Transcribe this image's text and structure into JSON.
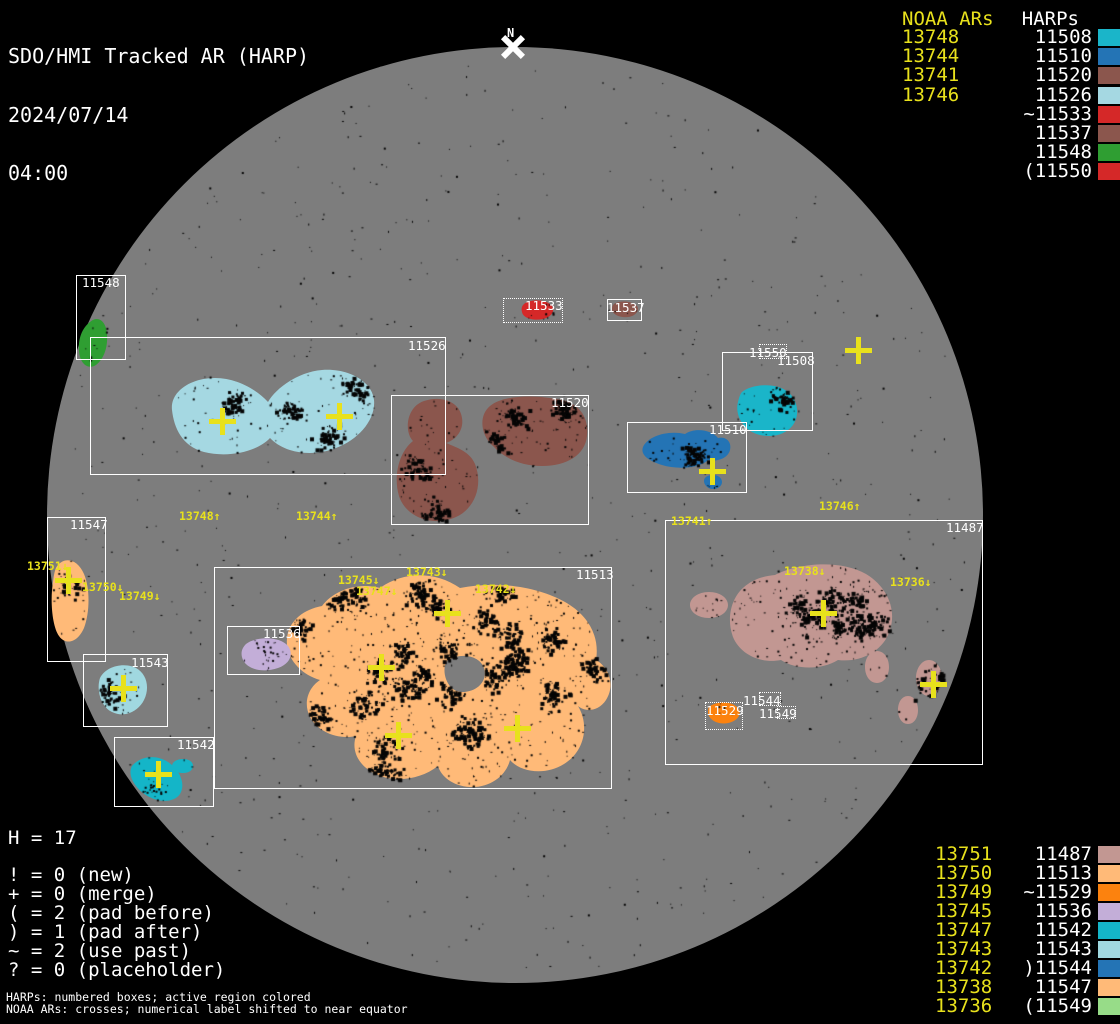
{
  "title": {
    "line1": "SDO/HMI Tracked AR (HARP)",
    "line2": "2024/07/14",
    "line3": "04:00"
  },
  "north": {
    "label": "N"
  },
  "sun": {
    "disk_color": "#7d7d7d",
    "speckle_color": "#050505"
  },
  "legend_top": {
    "noaa_header": "NOAA ARs",
    "harp_header": "HARPs",
    "rows": [
      {
        "noaa": "13748",
        "harp": "11508",
        "color": "#1ab5c9"
      },
      {
        "noaa": "13744",
        "harp": "11510",
        "color": "#2474b5"
      },
      {
        "noaa": "13741",
        "harp": "11520",
        "color": "#8b564d"
      },
      {
        "noaa": "13746",
        "harp": "11526",
        "color": "#a5d8e2"
      },
      {
        "noaa": "",
        "harp": "~11533",
        "color": "#d52828"
      },
      {
        "noaa": "",
        "harp": "11537",
        "color": "#8b564d"
      },
      {
        "noaa": "",
        "harp": "11548",
        "color": "#2f9e32"
      },
      {
        "noaa": "",
        "harp": "(11550",
        "color": "#d52828"
      }
    ]
  },
  "legend_bottom": {
    "rows": [
      {
        "noaa": "13751",
        "harp": "11487",
        "color": "#c29792"
      },
      {
        "noaa": "13750",
        "harp": "11513",
        "color": "#ffba78"
      },
      {
        "noaa": "13749",
        "harp": "~11529",
        "color": "#fc820e"
      },
      {
        "noaa": "13745",
        "harp": "11536",
        "color": "#c3aed8"
      },
      {
        "noaa": "13747",
        "harp": "11542",
        "color": "#14b5c8"
      },
      {
        "noaa": "13743",
        "harp": "11543",
        "color": "#a0d8e0"
      },
      {
        "noaa": "13742",
        "harp": ")11544",
        "color": "#2474b5"
      },
      {
        "noaa": "13738",
        "harp": "11547",
        "color": "#ffba78"
      },
      {
        "noaa": "13736",
        "harp": "(11549",
        "color": "#97dc88"
      }
    ]
  },
  "stats": {
    "h_line": "H = 17",
    "symbol_lines": [
      "! = 0 (new)",
      "+ = 0 (merge)",
      "( = 2 (pad before)",
      ") = 1 (pad after)",
      "~ = 2 (use past)",
      "? = 0 (placeholder)"
    ],
    "footnotes": [
      "HARPs: numbered boxes; active region colored",
      "NOAA ARs: crosses; numerical label shifted to near equator"
    ]
  },
  "regions": {
    "11548": "#2f9e32",
    "11526": "#a5d8e2",
    "11520": "#8b564d",
    "11533": "#d52828",
    "11537": "#8b564d",
    "11508": "#1ab5c9",
    "11510": "#2474b5",
    "11547": "#ffba78",
    "11543": "#a0d8e0",
    "11542": "#14b5c8",
    "11513": "#ffba78",
    "11536": "#c3aed8",
    "11529": "#fc820e",
    "11487": "#c29792"
  },
  "harp_boxes": [
    {
      "harp": "11548",
      "x": 76,
      "y": 275,
      "w": 50,
      "h": 85,
      "style": "solid",
      "lx": 82,
      "ly": 277
    },
    {
      "harp": "11526",
      "x": 90,
      "y": 337,
      "w": 356,
      "h": 138,
      "style": "solid",
      "lx": 408,
      "ly": 340
    },
    {
      "harp": "11520",
      "x": 391,
      "y": 395,
      "w": 198,
      "h": 130,
      "style": "solid",
      "lx": 551,
      "ly": 397
    },
    {
      "harp": "11533",
      "x": 503,
      "y": 298,
      "w": 60,
      "h": 25,
      "style": "dotted",
      "lx": 525,
      "ly": 300
    },
    {
      "harp": "11537",
      "x": 607,
      "y": 299,
      "w": 35,
      "h": 22,
      "style": "solid",
      "lx": 607,
      "ly": 302
    },
    {
      "harp": "11550",
      "x": 759,
      "y": 344,
      "w": 28,
      "h": 15,
      "style": "dotted",
      "lx": 749,
      "ly": 347
    },
    {
      "harp": "11508",
      "x": 722,
      "y": 352,
      "w": 91,
      "h": 79,
      "style": "solid",
      "lx": 777,
      "ly": 355
    },
    {
      "harp": "11510",
      "x": 627,
      "y": 422,
      "w": 120,
      "h": 71,
      "style": "solid",
      "lx": 709,
      "ly": 424
    },
    {
      "harp": "11547",
      "x": 47,
      "y": 517,
      "w": 59,
      "h": 145,
      "style": "solid",
      "lx": 70,
      "ly": 519
    },
    {
      "harp": "11543",
      "x": 83,
      "y": 654,
      "w": 85,
      "h": 73,
      "style": "solid",
      "lx": 131,
      "ly": 657
    },
    {
      "harp": "11542",
      "x": 114,
      "y": 737,
      "w": 100,
      "h": 70,
      "style": "solid",
      "lx": 177,
      "ly": 739
    },
    {
      "harp": "11513",
      "x": 214,
      "y": 567,
      "w": 398,
      "h": 222,
      "style": "solid",
      "lx": 576,
      "ly": 569
    },
    {
      "harp": "11536",
      "x": 227,
      "y": 626,
      "w": 73,
      "h": 49,
      "style": "solid",
      "lx": 263,
      "ly": 628
    },
    {
      "harp": "11487",
      "x": 665,
      "y": 520,
      "w": 318,
      "h": 245,
      "style": "solid",
      "lx": 946,
      "ly": 522
    },
    {
      "harp": "11529",
      "x": 705,
      "y": 702,
      "w": 38,
      "h": 28,
      "style": "dotted",
      "lx": 706,
      "ly": 705
    },
    {
      "harp": "11544",
      "x": 759,
      "y": 692,
      "w": 22,
      "h": 14,
      "style": "dotted",
      "lx": 743,
      "ly": 695
    },
    {
      "harp": "11549",
      "x": 777,
      "y": 706,
      "w": 19,
      "h": 13,
      "style": "dotted",
      "lx": 759,
      "ly": 708
    }
  ],
  "ar_labels": [
    {
      "text": "13748↑",
      "x": 179,
      "y": 511
    },
    {
      "text": "13744↑",
      "x": 296,
      "y": 511
    },
    {
      "text": "13741↑",
      "x": 671,
      "y": 516
    },
    {
      "text": "13746↑",
      "x": 819,
      "y": 501
    },
    {
      "text": "13751↓",
      "x": 27,
      "y": 561
    },
    {
      "text": "13750↓",
      "x": 82,
      "y": 582
    },
    {
      "text": "13749↓",
      "x": 119,
      "y": 591
    },
    {
      "text": "13745↓",
      "x": 338,
      "y": 575
    },
    {
      "text": "13747↓",
      "x": 356,
      "y": 586
    },
    {
      "text": "13743↓",
      "x": 406,
      "y": 567
    },
    {
      "text": "13742↓",
      "x": 475,
      "y": 584
    },
    {
      "text": "13738↓",
      "x": 784,
      "y": 566
    },
    {
      "text": "13736↓",
      "x": 890,
      "y": 577
    }
  ],
  "crosses": [
    {
      "x": 222,
      "y": 421
    },
    {
      "x": 339,
      "y": 416
    },
    {
      "x": 858,
      "y": 350
    },
    {
      "x": 712,
      "y": 471
    },
    {
      "x": 68,
      "y": 580
    },
    {
      "x": 123,
      "y": 688
    },
    {
      "x": 158,
      "y": 774
    },
    {
      "x": 447,
      "y": 613
    },
    {
      "x": 381,
      "y": 667
    },
    {
      "x": 398,
      "y": 735
    },
    {
      "x": 517,
      "y": 728
    },
    {
      "x": 823,
      "y": 613
    },
    {
      "x": 933,
      "y": 684
    }
  ]
}
